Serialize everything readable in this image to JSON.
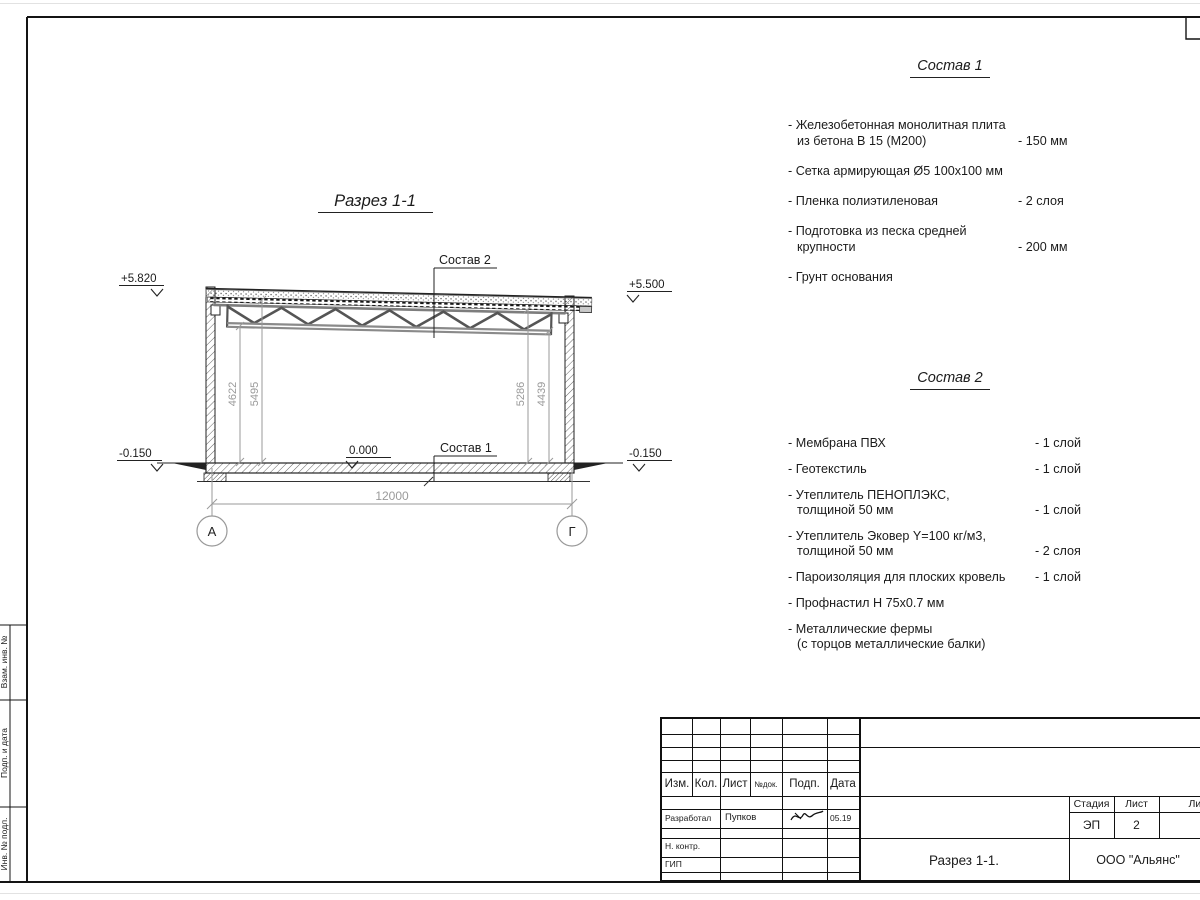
{
  "colors": {
    "ink": "#1b1b1b",
    "dim_gray": "#9a9a9a"
  },
  "drawing": {
    "title": "Разрез 1-1",
    "composition1_label": "Состав 1",
    "composition2_label": "Состав 2",
    "elev_top_left": "+5.820",
    "elev_top_right": "+5.500",
    "elev_zero": "0.000",
    "elev_bottom_left": "-0.150",
    "elev_bottom_right": "-0.150",
    "dim_span": "12000",
    "dim_left_inner": "4622",
    "dim_left_outer": "5495",
    "dim_right_inner": "5286",
    "dim_right_outer": "4439",
    "axis_left": "А",
    "axis_right": "Г"
  },
  "composition1": {
    "title": "Состав 1",
    "items": [
      {
        "line1": "- Железобетонная  монолитная плита",
        "line2": "из бетона В 15 (М200)",
        "value": "- 150 мм"
      },
      {
        "line1": "- Сетка армирующая Ø5 100х100 мм"
      },
      {
        "line1": "- Пленка полиэтиленовая",
        "value": "- 2 слоя"
      },
      {
        "line1": "- Подготовка из песка средней",
        "line2": "крупности",
        "value": "- 200 мм"
      },
      {
        "line1": "- Грунт основания"
      }
    ]
  },
  "composition2": {
    "title": "Состав 2",
    "items": [
      {
        "line1": "- Мембрана ПВХ",
        "value": "- 1 слой"
      },
      {
        "line1": "- Геотекстиль",
        "value": "- 1 слой"
      },
      {
        "line1": "- Утеплитель ПЕНОПЛЭКС,",
        "line2": "толщиной 50 мм",
        "value": "- 1 слой"
      },
      {
        "line1": "- Утеплитель Эковер Y=100 кг/м3,",
        "line2": "толщиной 50 мм",
        "value": "- 2 слоя"
      },
      {
        "line1": "- Пароизоляция для плоских кровель",
        "value": "- 1 слой"
      },
      {
        "line1": "- Профнастил Н 75х0.7 мм"
      },
      {
        "line1": "- Металлические фермы",
        "line2": "(с торцов металлические балки)"
      }
    ]
  },
  "titleblock": {
    "rev_headers": {
      "izm": "Изм.",
      "kol": "Кол.",
      "list": "Лист",
      "ndok": "№док.",
      "podp": "Подп.",
      "data": "Дата"
    },
    "developed_label": "Разработал",
    "developed_name": "Пупков",
    "developed_date": "05.19",
    "ncontr_label": "Н. контр.",
    "gip_label": "ГИП",
    "stage_label": "Стадия",
    "sheet_label": "Лист",
    "sheets_label": "Листов",
    "stage_value": "ЭП",
    "sheet_value": "2",
    "doc_name": "Разрез 1-1.",
    "company": "ООО \"Альянс\""
  },
  "margin_labels": {
    "vzam": "Взам. инв. №",
    "podp": "Подп. и дата",
    "inv": "Инв. № подл."
  }
}
